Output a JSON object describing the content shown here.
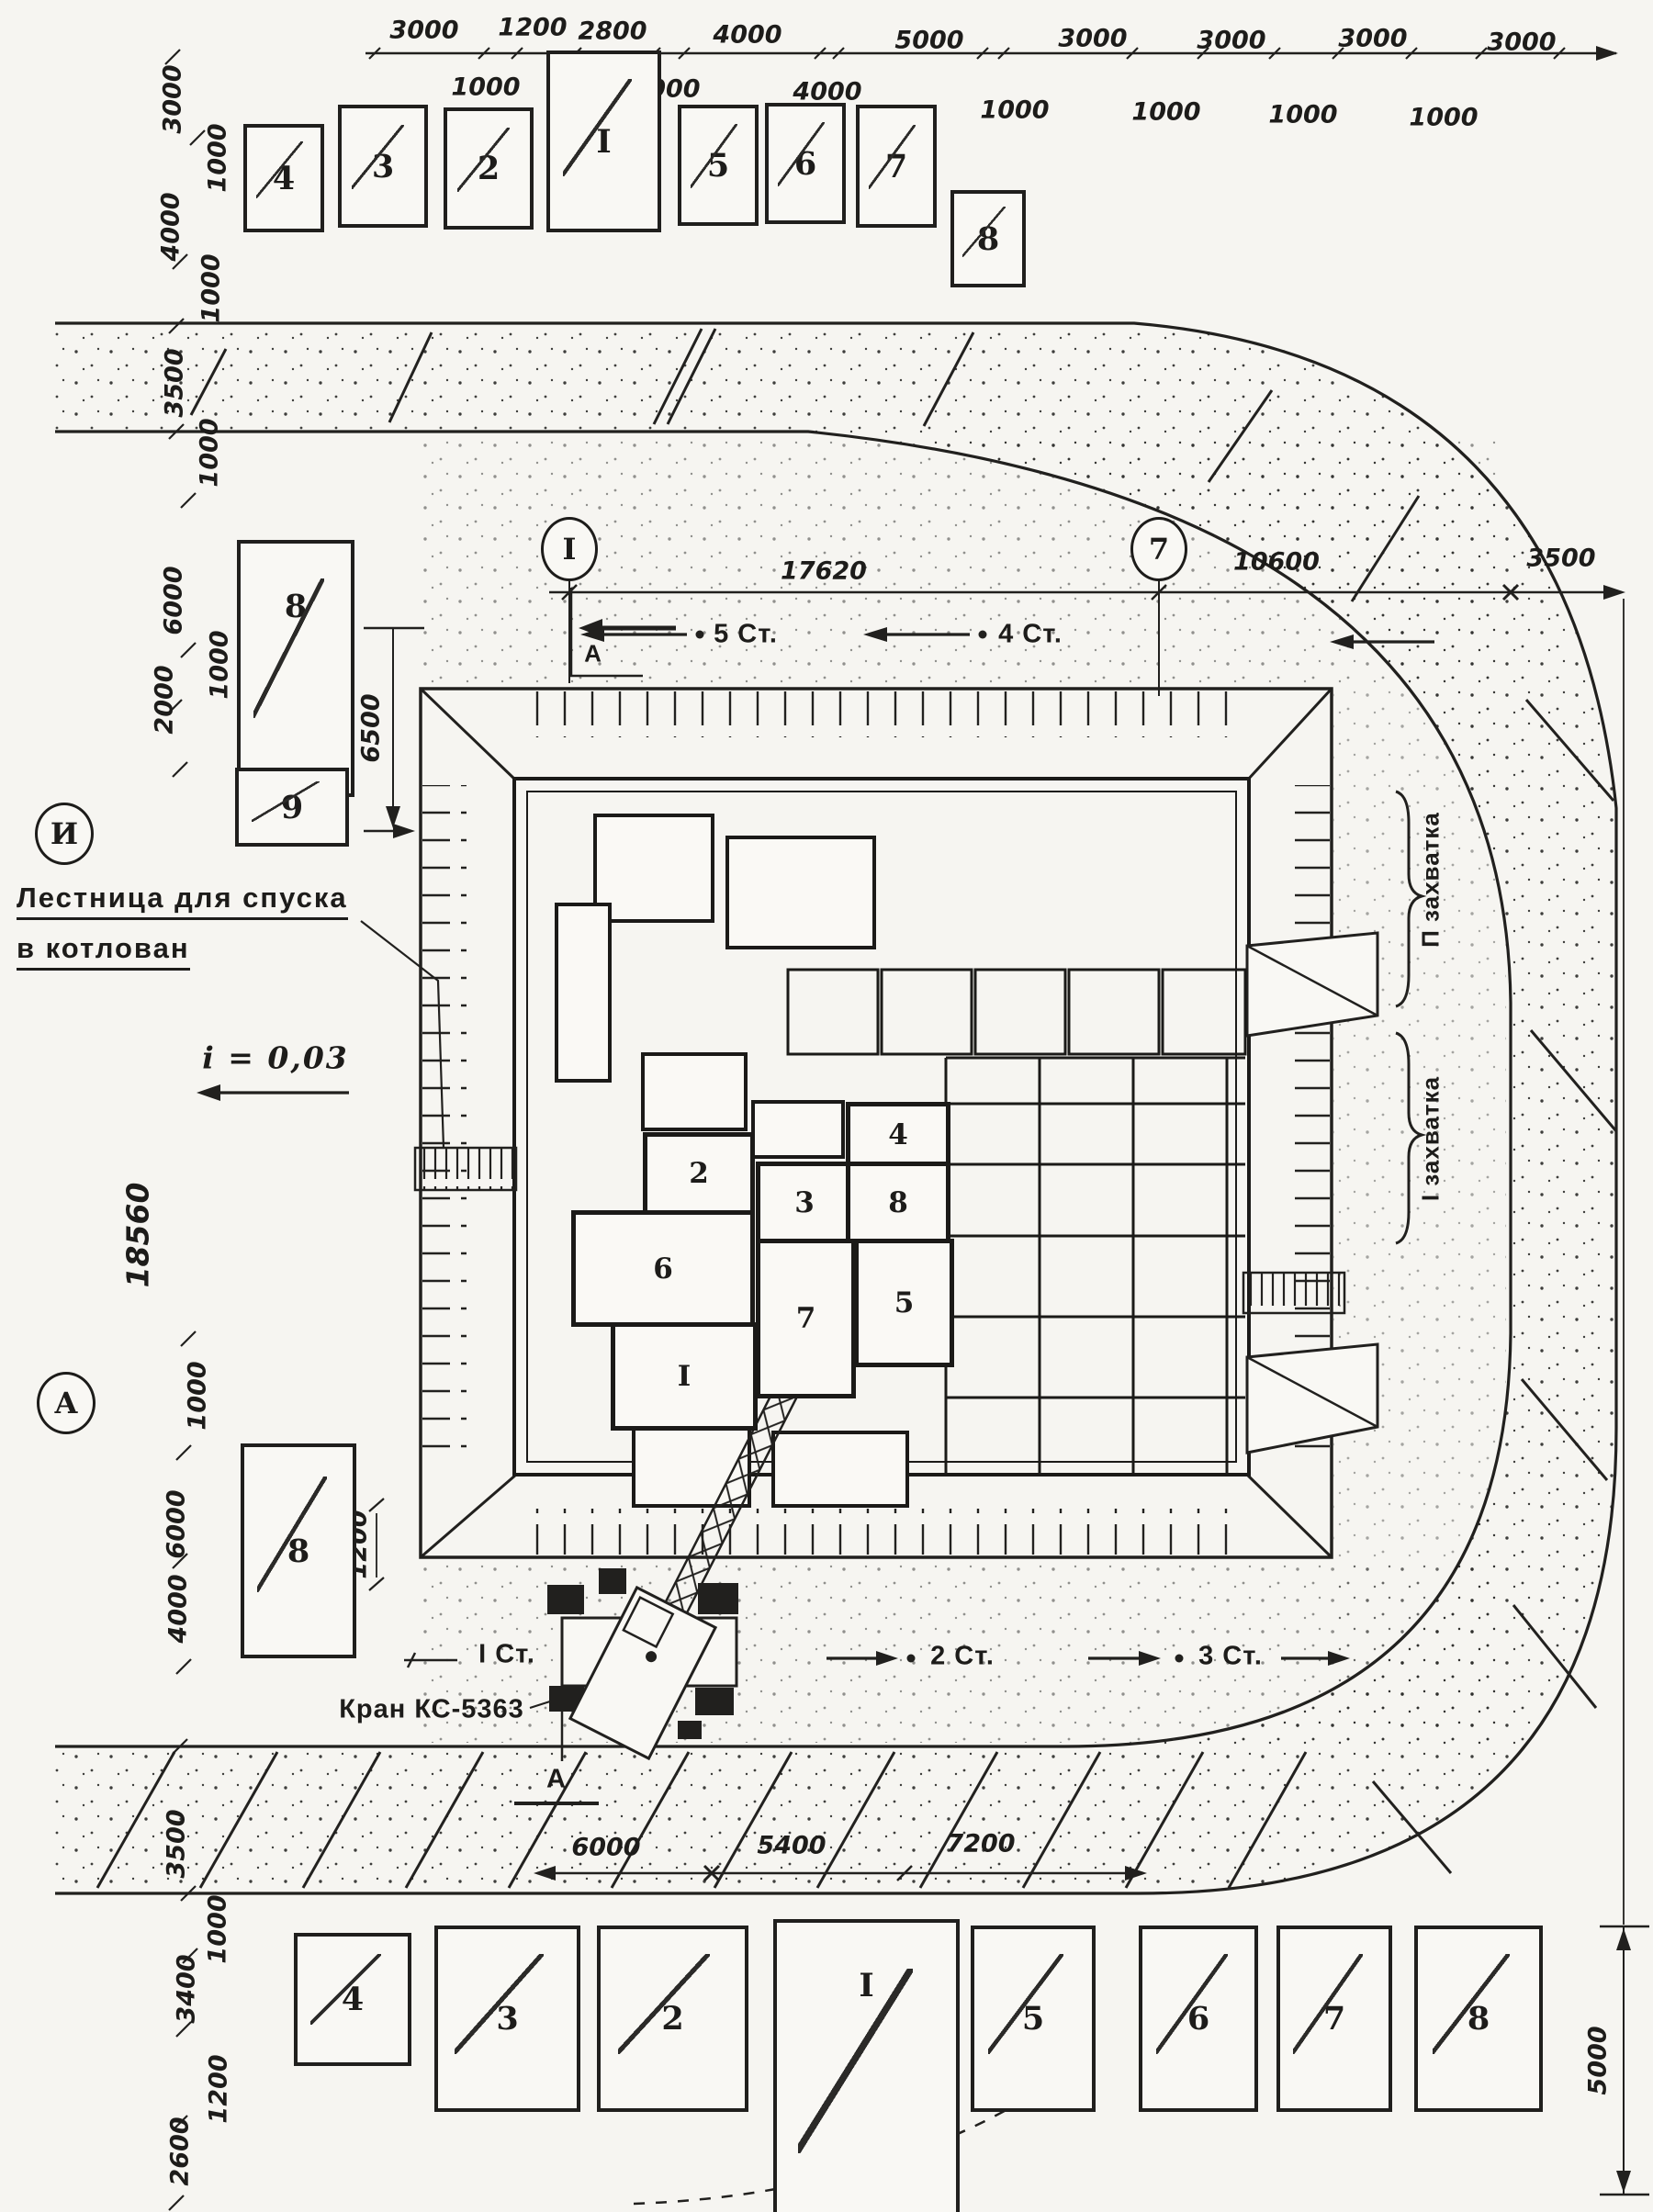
{
  "top_dims": {
    "row1": [
      "3000",
      "1200",
      "2800",
      "4000",
      "5000",
      "3000",
      "3000",
      "3000",
      "3000"
    ],
    "row2": [
      "1000",
      "1000",
      "4000",
      "1000",
      "1000",
      "1000",
      "1000"
    ]
  },
  "left_dims": [
    "3000",
    "1000",
    "4000",
    "1000",
    "3500",
    "1000",
    "6000",
    "1000",
    "2000",
    "18560",
    "1000",
    "6000",
    "4000",
    "3500",
    "1000",
    "3400",
    "1200",
    "2600"
  ],
  "axis_dims": {
    "d17620": "17620",
    "d10600": "10600",
    "d3500": "3500"
  },
  "vert_dims": {
    "d6500": "6500",
    "d1200": "1200",
    "d5000": "5000"
  },
  "road_dims": [
    "6000",
    "5400",
    "7200"
  ],
  "grid_markers": {
    "left": "I",
    "right": "7",
    "row_top": "И",
    "row_bottom": "А"
  },
  "stations": {
    "st1": "I Ст.",
    "st2": "2 Ст.",
    "st3": "3 Ст.",
    "st4": "4 Ст.",
    "st5": "5 Ст."
  },
  "notes": {
    "ladder1": "Лестница для спуска",
    "ladder2": "в котлован",
    "slope": "i = 0,03",
    "crane": "Кран КС-5363",
    "zone2": "П захватка",
    "zone1": "I захватка",
    "section": "А"
  },
  "top_blocks": [
    "4",
    "3",
    "2",
    "I",
    "5",
    "6",
    "7",
    "8"
  ],
  "bottom_blocks": [
    "4",
    "3",
    "2",
    "I",
    "5",
    "6",
    "7",
    "8"
  ],
  "left_blocks": [
    "8",
    "9",
    "8"
  ],
  "pit_blocks": [
    "2",
    "4",
    "3",
    "8",
    "6",
    "7",
    "5",
    "I"
  ]
}
